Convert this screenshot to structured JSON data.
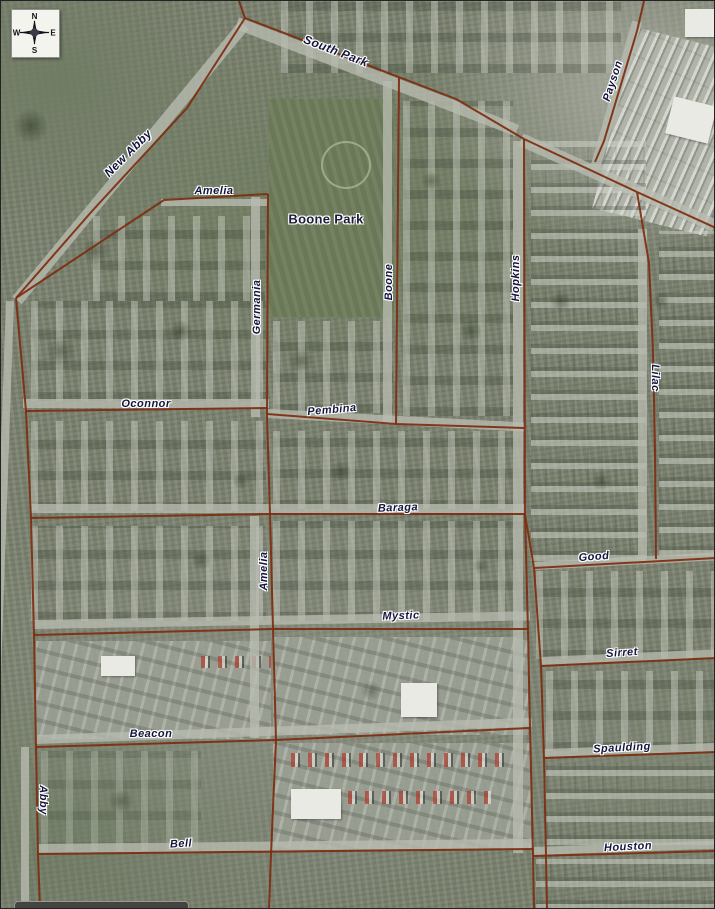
{
  "compass": {
    "n": "N",
    "e": "E",
    "s": "S",
    "w": "W"
  },
  "park": {
    "label": "Boone Park"
  },
  "streets": [
    {
      "text": "South Park"
    },
    {
      "text": "Payson"
    },
    {
      "text": "New Abby"
    },
    {
      "text": "Amelia"
    },
    {
      "text": "Germania"
    },
    {
      "text": "Boone"
    },
    {
      "text": "Hopkins"
    },
    {
      "text": "Lilac"
    },
    {
      "text": "Oconnor"
    },
    {
      "text": "Pembina"
    },
    {
      "text": "Baraga"
    },
    {
      "text": "Good"
    },
    {
      "text": "Amelia"
    },
    {
      "text": "Mystic"
    },
    {
      "text": "Sirret"
    },
    {
      "text": "Spaulding"
    },
    {
      "text": "Beacon"
    },
    {
      "text": "Abby"
    },
    {
      "text": "Bell"
    },
    {
      "text": "Houston"
    }
  ],
  "style": {
    "boundary_color": "#7e2d0f",
    "label_color": "#15153d",
    "halo_color": "#ffffff",
    "terrain_color": "#7b826f"
  }
}
